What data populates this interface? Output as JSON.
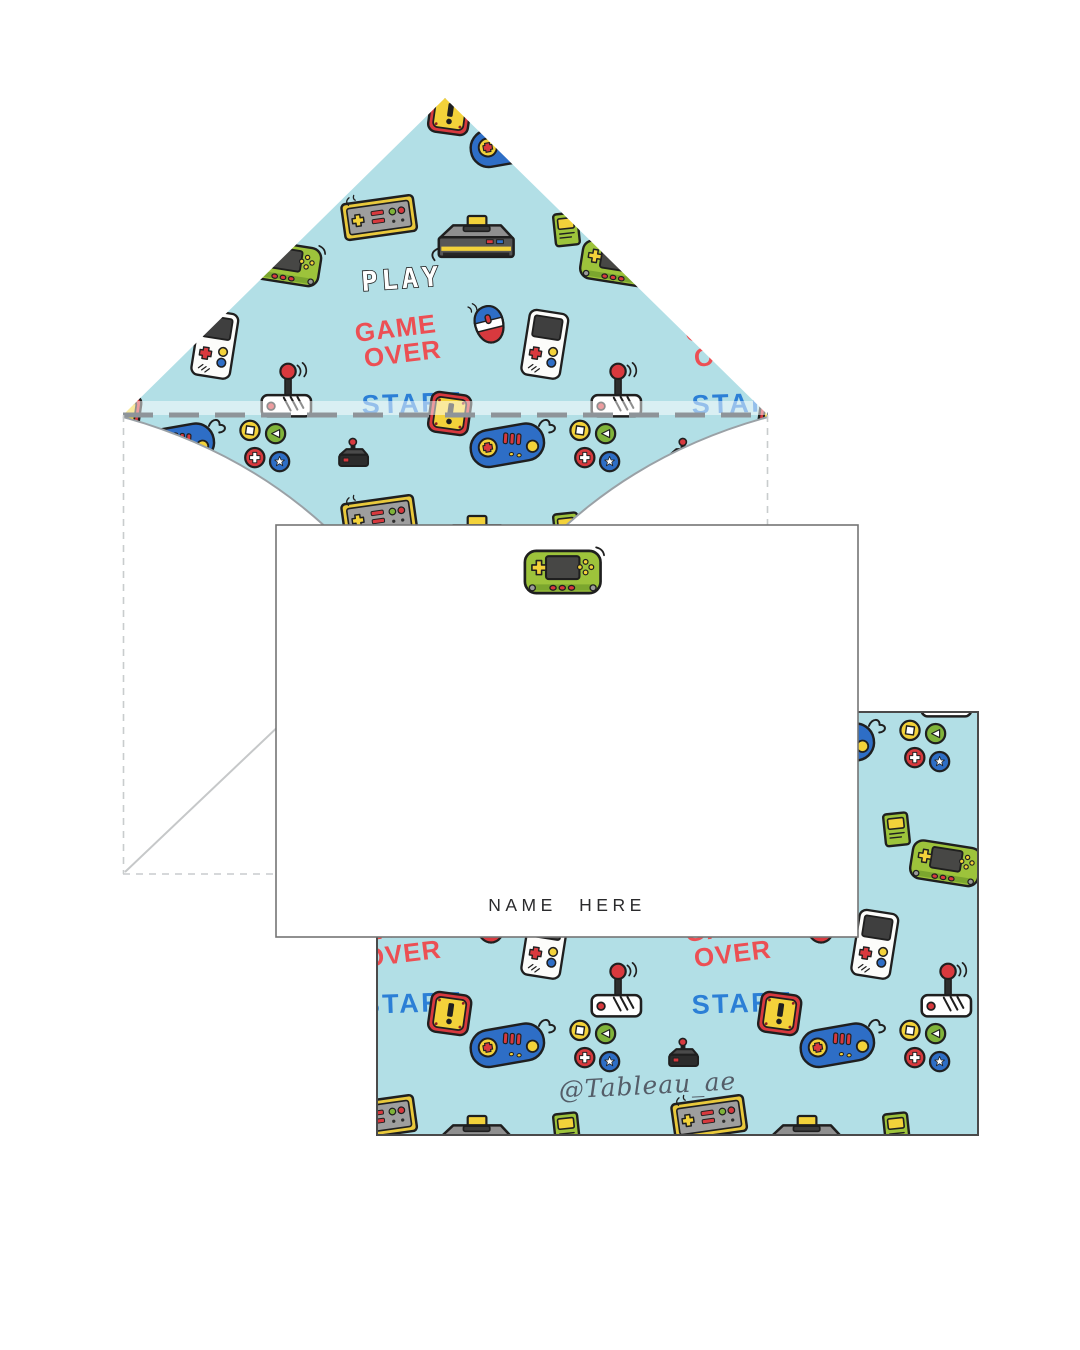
{
  "pattern": {
    "background_color": "#b2dfe6",
    "words": {
      "game": "GAME",
      "over": "OVER",
      "start": "START",
      "play": "PLAY"
    },
    "word_colors": {
      "game_over": "#ec4f54",
      "start": "#2b7fd6",
      "play": "#ffffff"
    },
    "accent_colors": {
      "red": "#d8393e",
      "yellow": "#f3d23a",
      "green": "#9dc33b",
      "blue": "#2e6ec6",
      "outline": "#1f1f1f"
    },
    "icon_names": [
      "game-console",
      "blue-gamepad",
      "green-handheld-console",
      "white-handheld-console",
      "arcade-joystick",
      "black-joystick",
      "computer-mouse",
      "yellow-controller",
      "exclamation-block",
      "game-cartridge",
      "coin-badge",
      "arrow-badge",
      "cross-badge",
      "star-badge"
    ]
  },
  "front_card": {
    "name_text": "NAME HERE"
  },
  "back_card": {
    "watermark_text": "@Tableau_ae"
  }
}
